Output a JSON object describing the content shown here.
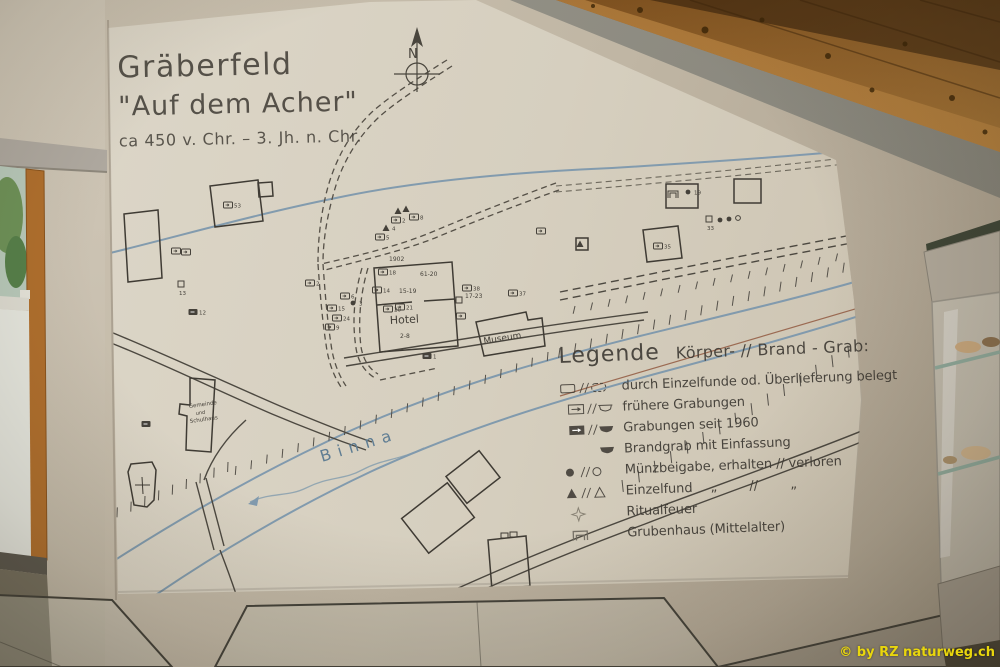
{
  "credit": "© by RZ naturweg.ch",
  "map": {
    "title_line1": "Gräberfeld",
    "title_line2": "\"Auf dem  Acher\"",
    "title_line3": "ca 450 v. Chr.  –  3. Jh. n. Chr.",
    "compass_label": "N",
    "colors": {
      "ink": "#45413a",
      "water": "#7d98ad",
      "panel": "#d6cfbf"
    },
    "texts": [
      {
        "x": 322,
        "y": 462,
        "s": "Binna",
        "size": 16,
        "rot": -17,
        "ls": 7,
        "color": "#5f7d93"
      },
      {
        "x": 390,
        "y": 324,
        "s": "Hotel",
        "size": 11,
        "rot": -3
      },
      {
        "x": 484,
        "y": 344,
        "s": "Museum",
        "size": 9,
        "rot": -9
      },
      {
        "x": 189,
        "y": 408,
        "s": "Gemeinde",
        "size": 5.5,
        "rot": -8
      },
      {
        "x": 196,
        "y": 415,
        "s": "und",
        "size": 5,
        "rot": -8
      },
      {
        "x": 190,
        "y": 423,
        "s": "Schulhaus",
        "size": 5.5,
        "rot": -8
      },
      {
        "x": 389,
        "y": 261,
        "s": "1902",
        "size": 6
      },
      {
        "x": 420,
        "y": 276,
        "s": "61-20",
        "size": 6
      },
      {
        "x": 399,
        "y": 293,
        "s": "15-19",
        "size": 6
      },
      {
        "x": 400,
        "y": 338,
        "s": "2-8",
        "size": 6
      },
      {
        "x": 465,
        "y": 298,
        "s": "17-23",
        "size": 6
      }
    ],
    "symbols": [
      {
        "x": 383,
        "y": 272,
        "t": "rect",
        "l": "18"
      },
      {
        "x": 377,
        "y": 290,
        "t": "rect",
        "l": "14"
      },
      {
        "x": 388,
        "y": 309,
        "t": "rect",
        "l": "20"
      },
      {
        "x": 400,
        "y": 307,
        "t": "rect",
        "l": "21"
      },
      {
        "x": 427,
        "y": 356,
        "t": "rect-filled",
        "l": "1"
      },
      {
        "x": 459,
        "y": 300,
        "t": "sq",
        "l": ""
      },
      {
        "x": 461,
        "y": 316,
        "t": "rect",
        "l": ""
      },
      {
        "x": 467,
        "y": 288,
        "t": "rect",
        "l": "38"
      },
      {
        "x": 513,
        "y": 293,
        "t": "rect",
        "l": "37"
      },
      {
        "x": 398,
        "y": 211,
        "t": "tri",
        "l": ""
      },
      {
        "x": 406,
        "y": 209,
        "t": "tri",
        "l": ""
      },
      {
        "x": 396,
        "y": 220,
        "t": "rect",
        "l": "2"
      },
      {
        "x": 414,
        "y": 217,
        "t": "rect",
        "l": "8"
      },
      {
        "x": 386,
        "y": 228,
        "t": "tri",
        "l": "4"
      },
      {
        "x": 380,
        "y": 237,
        "t": "rect",
        "l": "5"
      },
      {
        "x": 332,
        "y": 308,
        "t": "rect",
        "l": "15"
      },
      {
        "x": 345,
        "y": 296,
        "t": "rect",
        "l": "6"
      },
      {
        "x": 353,
        "y": 303,
        "t": "dot",
        "l": "3"
      },
      {
        "x": 337,
        "y": 318,
        "t": "rect",
        "l": "24"
      },
      {
        "x": 330,
        "y": 327,
        "t": "rect",
        "l": "9"
      },
      {
        "x": 310,
        "y": 283,
        "t": "rect",
        "l": "2"
      },
      {
        "x": 193,
        "y": 312,
        "t": "rect-filled",
        "l": "12"
      },
      {
        "x": 146,
        "y": 424,
        "t": "rect-filled",
        "l": ""
      },
      {
        "x": 176,
        "y": 251,
        "t": "rect",
        "l": ""
      },
      {
        "x": 186,
        "y": 252,
        "t": "rect",
        "l": ""
      },
      {
        "x": 181,
        "y": 284,
        "t": "sq",
        "l": "13"
      },
      {
        "x": 228,
        "y": 205,
        "t": "rect",
        "l": "53"
      },
      {
        "x": 658,
        "y": 246,
        "t": "rect",
        "l": "35"
      },
      {
        "x": 673,
        "y": 194,
        "t": "grub",
        "l": ""
      },
      {
        "x": 688,
        "y": 192,
        "t": "dot",
        "l": "19"
      },
      {
        "x": 709,
        "y": 219,
        "t": "sq",
        "l": "33"
      },
      {
        "x": 720,
        "y": 220,
        "t": "dot",
        "l": ""
      },
      {
        "x": 729,
        "y": 219,
        "t": "dot",
        "l": ""
      },
      {
        "x": 738,
        "y": 218,
        "t": "dot-open",
        "l": ""
      },
      {
        "x": 580,
        "y": 244,
        "t": "tri",
        "l": ""
      },
      {
        "x": 541,
        "y": 231,
        "t": "rect",
        "l": ""
      }
    ]
  },
  "legend": {
    "heading": "Legende",
    "subheading": "Körper- // Brand - Grab:",
    "rows": [
      {
        "label": "durch Einzelfunde od. Überlieferung belegt"
      },
      {
        "label": "frühere Grabungen"
      },
      {
        "label": "Grabungen seit 1960"
      },
      {
        "label": "Brandgrab mit Einfassung"
      },
      {
        "label": "Münzbeigabe, erhalten // verloren"
      },
      {
        "label": "Einzelfund",
        "suffix": "   „        //        „"
      },
      {
        "label": "Ritualfeuer"
      },
      {
        "label": "Grubenhaus (Mittelalter)"
      }
    ]
  }
}
